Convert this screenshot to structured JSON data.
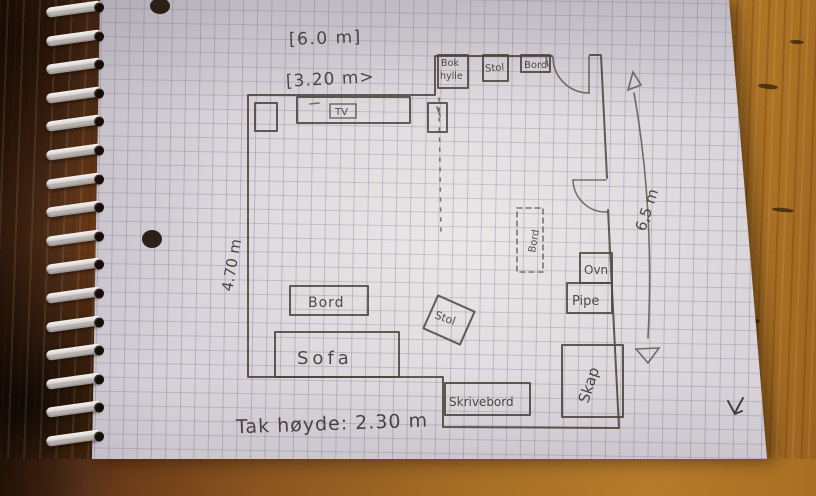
{
  "scene": {
    "description": "Hand-drawn floor plan sketch in pencil on squared spiral-notebook paper lying on a wooden table",
    "colors": {
      "pencil": "#4a443c",
      "paper": "#d8d4d9",
      "grid_line": "#766c8c",
      "wood_right": "#b67c2c",
      "wood_left": "#3a2010",
      "spiral_wire": "#ebe8e6"
    }
  },
  "plan": {
    "dimensions": {
      "top_width": "[6.0 m]",
      "inner_width": "[3.20 m>",
      "left_height": "4.70 m",
      "right_height": "6,5 m",
      "ceiling_height": "Tak høyde: 2.30 m"
    },
    "furniture": {
      "bokhylle": {
        "label": "Bok hylle",
        "lines": [
          "Bok",
          "hylle"
        ]
      },
      "stol_top": {
        "label": "Stol"
      },
      "bord_top": {
        "label": "Bord"
      },
      "tv": {
        "label": "TV"
      },
      "bord_dashed": {
        "label": "Bord"
      },
      "ovn": {
        "label": "Ovn"
      },
      "pipe": {
        "label": "Pipe"
      },
      "bord_coffee": {
        "label": "Bord"
      },
      "sofa": {
        "label": "Sofa"
      },
      "stol_rotated": {
        "label": "Stol"
      },
      "skrivebord": {
        "label": "Skrivebord"
      },
      "skap": {
        "label": "Skap"
      }
    }
  }
}
